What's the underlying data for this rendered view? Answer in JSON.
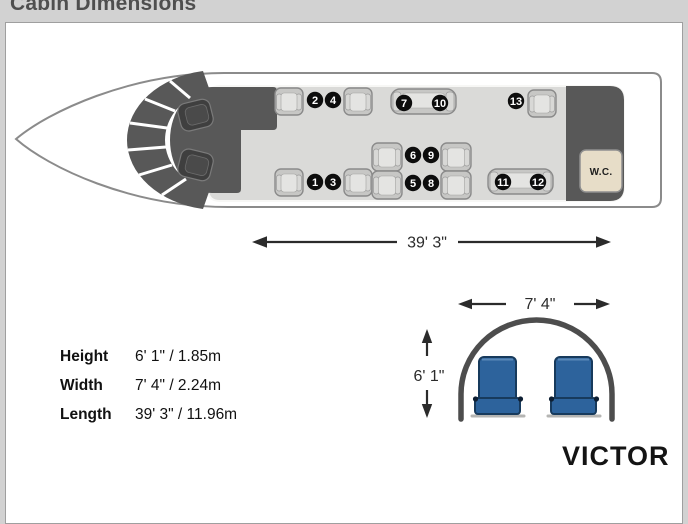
{
  "header": {
    "title": "Cabin Dimensions"
  },
  "plane": {
    "wc_label": "W.C.",
    "seat_numbers": [
      "1",
      "2",
      "3",
      "4",
      "5",
      "6",
      "7",
      "8",
      "9",
      "10",
      "11",
      "12",
      "13"
    ]
  },
  "dims": {
    "length_ft": "39' 3\"",
    "width_ft": "7' 4\"",
    "height_ft": "6' 1\"",
    "rows": [
      {
        "label": "Height",
        "value": "6' 1\" / 1.85m"
      },
      {
        "label": "Width",
        "value": "7' 4\" / 2.24m"
      },
      {
        "label": "Length",
        "value": "39' 3\" / 11.96m"
      }
    ]
  },
  "branding": {
    "logo_text": "VICTOR"
  }
}
